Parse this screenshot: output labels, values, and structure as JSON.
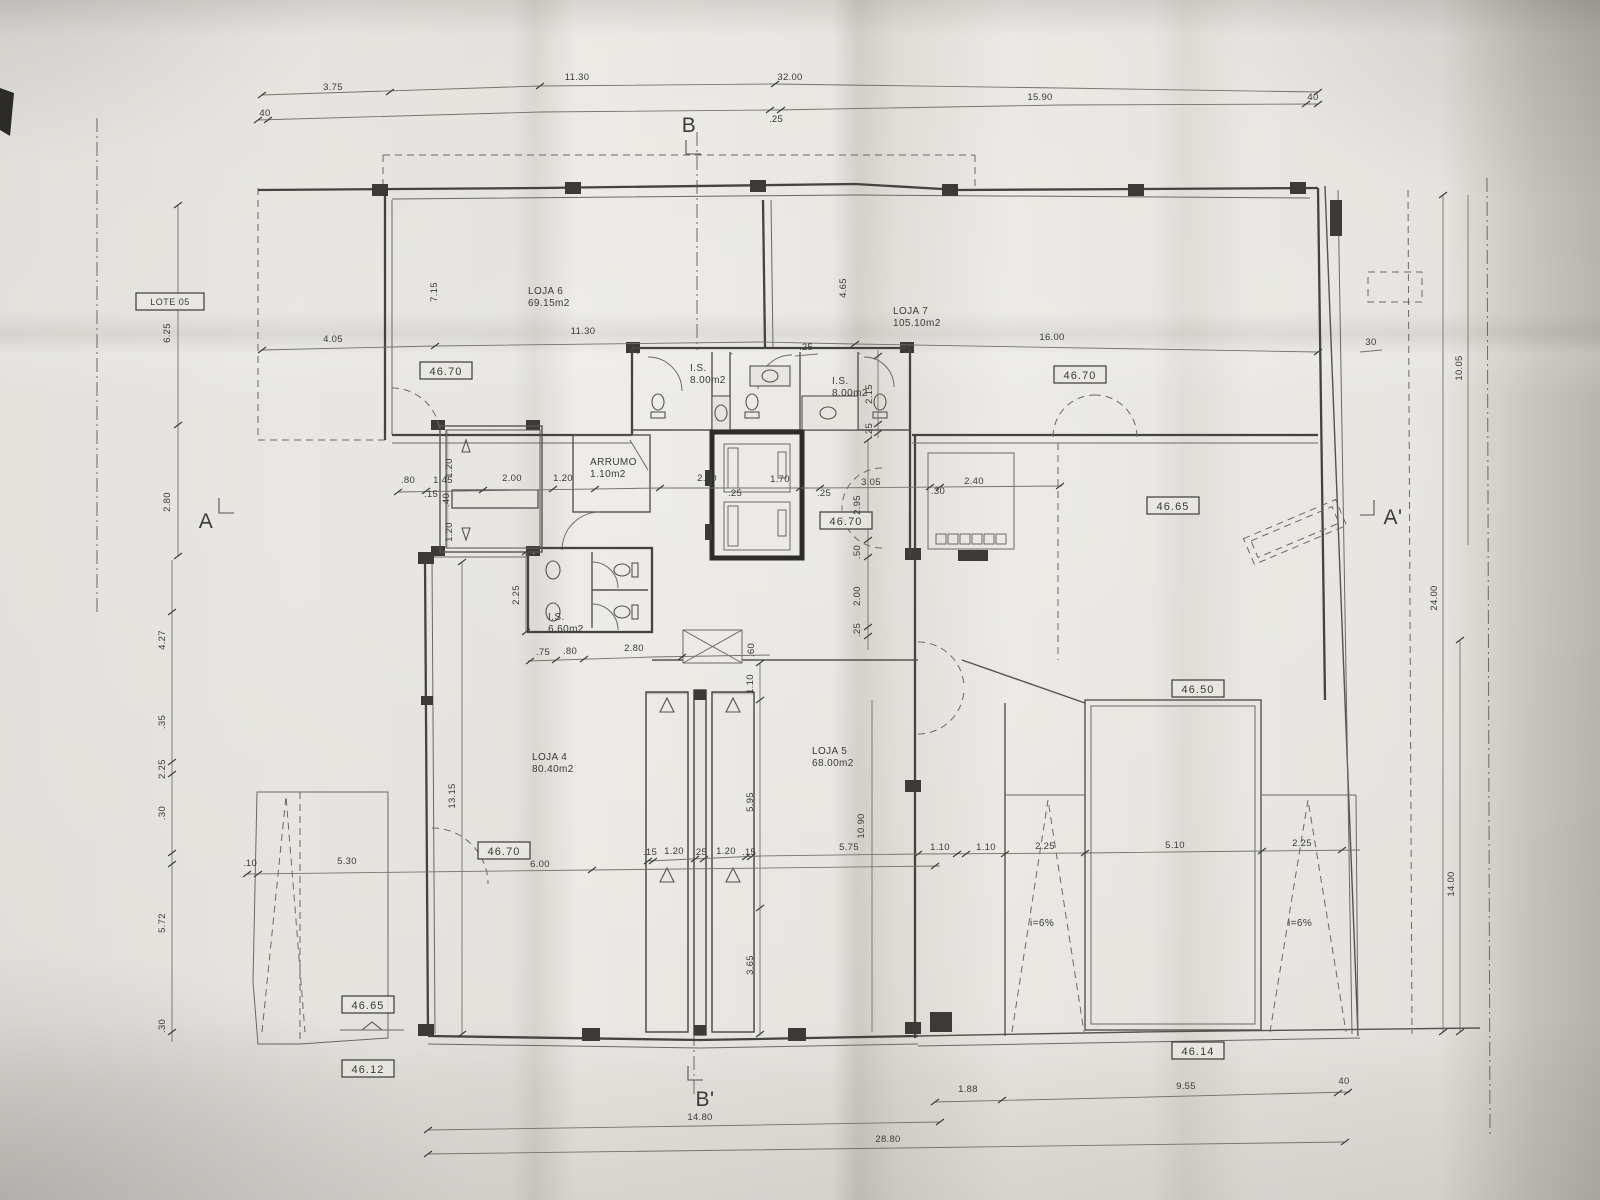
{
  "sections": {
    "b_top": "B",
    "b_bottom": "B'",
    "a_left": "A",
    "a_right": "A'"
  },
  "lot": {
    "label": "LOTE 05"
  },
  "rooms": {
    "loja6": {
      "name": "LOJA 6",
      "area": "69.15m2"
    },
    "loja7": {
      "name": "LOJA 7",
      "area": "105.10m2"
    },
    "loja4": {
      "name": "LOJA 4",
      "area": "80.40m2"
    },
    "loja5": {
      "name": "LOJA 5",
      "area": "68.00m2"
    },
    "is1": {
      "name": "I.S.",
      "area": "8.00m2"
    },
    "is2": {
      "name": "I.S.",
      "area": "8.00m2"
    },
    "is3": {
      "name": "I.S.",
      "area": "6.60m2"
    },
    "arrumo": {
      "name": "ARRUMO",
      "area": "1.10m2"
    }
  },
  "levels": {
    "lv1": "46.70",
    "lv2": "46.70",
    "lv3": "46.70",
    "lv4": "46.65",
    "lv5": "46.50",
    "lv6": "46.70",
    "lv7": "46.65",
    "lv8": "46.12",
    "lv9": "46.14"
  },
  "ramps": {
    "left": "i=6%",
    "right": "i=6%"
  },
  "dims": {
    "tu1": "3.75",
    "tu2": "11.30",
    "tu3": "32.00",
    "tl1": "40",
    "tl2": ".25",
    "tl3": "15.90",
    "tl4": "40",
    "sr1": "4.05",
    "sr2": "11.30",
    "sr3": "16.00",
    "vu1": "7.15",
    "vu2": "4.65",
    "vu3": "6.25",
    "vu4": "2.80",
    "sc1": ".80",
    "sc2": "1.45",
    "sc3": ".15",
    "sc4": "2.00",
    "sc5": "1.20",
    "sc6": "2.10",
    "sc7": ".25",
    "sc8": "1.70",
    "sc9": "1.20",
    "sc10": ".40",
    "sc11": "1.20",
    "mc1": ".25",
    "mc2": "3.05",
    "mc3": ".30",
    "mc4": "2.40",
    "mc5": "2.95",
    "mc6": ".50",
    "mc7": "2.00",
    "mc8": ".25",
    "it1": ".25",
    "it2": "2.15",
    "it3": ".25",
    "wc1": "2.25",
    "wc2": ".75",
    "wc3": ".80",
    "wc4": "2.80",
    "wc5": ".60",
    "st1": "1.10",
    "st2": "5.95",
    "st3": "3.65",
    "st4": "13.15",
    "st5": ".15",
    "st6": "1.20",
    "st7": ".25",
    "st8": "1.20",
    "st9": ".15",
    "rc1": "10.90",
    "rc2": "5.75",
    "rc3": "1.10",
    "rc4": "1.10",
    "rc5": "2.25",
    "rc6": "5.10",
    "rc7": "2.25",
    "lc1": "4.27",
    "lc2": ".35",
    "lc3": "2.25",
    "lc4": ".30",
    "lc5": "5.72",
    "lc6": ".30",
    "lc7": ".10",
    "bl1": "5.30",
    "bl2": "6.00",
    "bt1": "1.88",
    "bt2": "9.55",
    "bt3": "40",
    "bt4": "14.80",
    "bt5": "28.80",
    "rv1": "10.05",
    "rv2": "30",
    "rv3": "24.00",
    "rv4": "14.00"
  }
}
